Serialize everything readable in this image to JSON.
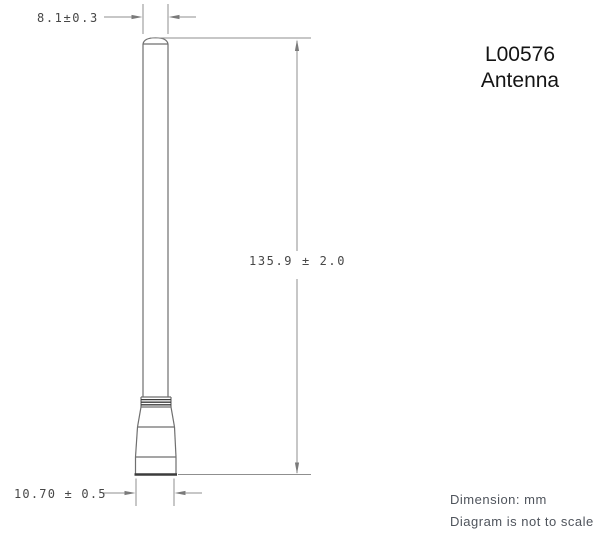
{
  "drawing": {
    "part_number": "L00576",
    "part_name": "Antenna",
    "dim_tip_diameter": "8.1±0.3",
    "dim_overall_length": "135.9 ± 2.0",
    "dim_base_diameter": "10.70 ± 0.5",
    "note_units": "Dimension: mm",
    "note_scale": "Diagram is not to scale"
  },
  "colors": {
    "background": "#ffffff",
    "object_line": "#6f6f6f",
    "object_line_heavy": "#3c3c3c",
    "dimension_line": "#8f8f8f",
    "arrow_fill": "#7a7a7a",
    "dim_text": "#474747",
    "title_text": "#141414",
    "note_text": "#4f545c"
  }
}
